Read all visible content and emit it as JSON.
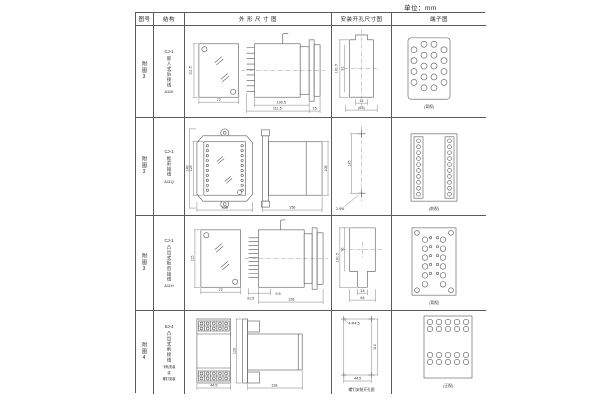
{
  "unit_label": "单位：mm",
  "headers": {
    "fig": "图号",
    "structure": "结构",
    "outline": "外 形 尺 寸 图",
    "mounting": "安装开孔尺寸图",
    "terminal": "端子图"
  },
  "rows": [
    {
      "fig": "附图3",
      "model": "CJ-1",
      "mount_type": "嵌入式后接线",
      "code": "A11K",
      "outline": {
        "front_h": "111.5",
        "front_w": "72",
        "body_l": "100.5",
        "total_l": "111.5",
        "rear_l": "15"
      },
      "mounting": {
        "h_outer": "101.5",
        "h_inner": "91",
        "w_slot": "14",
        "w_total": "(64)"
      },
      "terminal": {
        "view": "(背视)"
      }
    },
    {
      "fig": "附图3",
      "model": "CJ-1",
      "mount_type": "板前接线",
      "code": "A11Q",
      "outline": {
        "h_outer": "148",
        "h_inner": "125",
        "front_w": "105",
        "body_l": "156",
        "body_h": "105"
      },
      "mounting": {
        "pitch": "135",
        "holes": "2-Φ6"
      },
      "terminal": {
        "view": "(前视)"
      }
    },
    {
      "fig": "附图3",
      "model": "CJ-1",
      "mount_type": "凸出式板后接线",
      "code": "A11H",
      "outline": {
        "front_h": "115",
        "front_w": "72",
        "pin_l": "31.5",
        "step_l": "9.5",
        "body_l": "126"
      },
      "mounting": {
        "h_outer": "101.5",
        "h_inner": "76",
        "w_slot": "14",
        "w_total": "64"
      },
      "terminal": {
        "view": "(背视)"
      }
    },
    {
      "fig": "附图4",
      "model": "SJ-4",
      "mount_type": "凸出式前接线",
      "note_1": "卡轨安装",
      "note_2": "或",
      "note_3": "螺钉安装",
      "outline": {
        "front_w": "44.5",
        "front_h": "120",
        "body_l": "118"
      },
      "mounting": {
        "holes": "4-Φ4.5",
        "h": "112",
        "w": "44.5",
        "caption": "螺钉安装开孔图"
      },
      "terminal": {
        "view": "(正视)"
      }
    }
  ]
}
